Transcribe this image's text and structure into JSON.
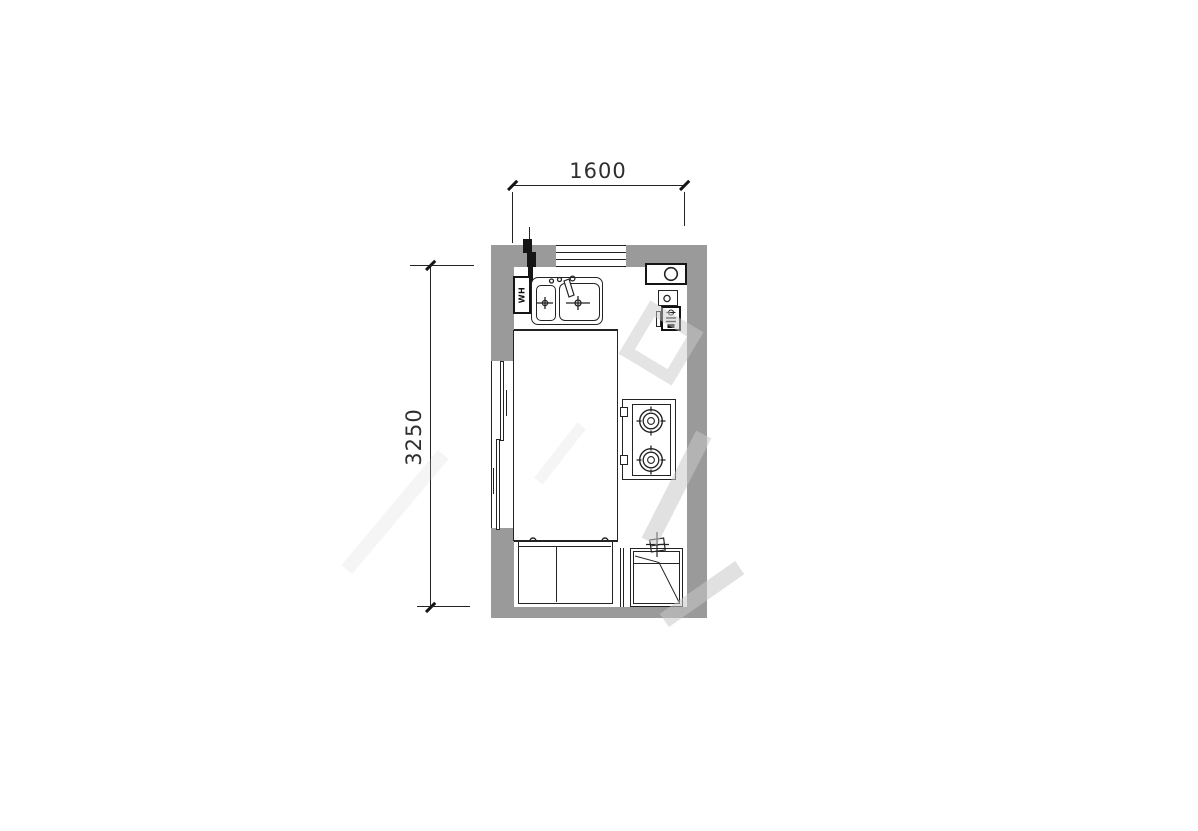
{
  "plan": {
    "type": "kitchen-floor-plan",
    "dimensions": {
      "width_mm": "1600",
      "height_mm": "3250"
    },
    "labels": {
      "water_heater": "WH"
    },
    "colors": {
      "background": "#ffffff",
      "wall_fill": "#9a9a9a",
      "line": "#232323",
      "fixture_black": "#151515",
      "dim_text": "#2f2f2f",
      "watermark": "rgba(201,201,201,0.55)"
    },
    "fixtures": [
      "window",
      "sliding-door",
      "water-heater",
      "double-sink",
      "faucet",
      "flue",
      "gas-meter",
      "gas-stove",
      "base-cabinet",
      "washing-machine",
      "water-valve",
      "gas-riser-pipe"
    ]
  }
}
